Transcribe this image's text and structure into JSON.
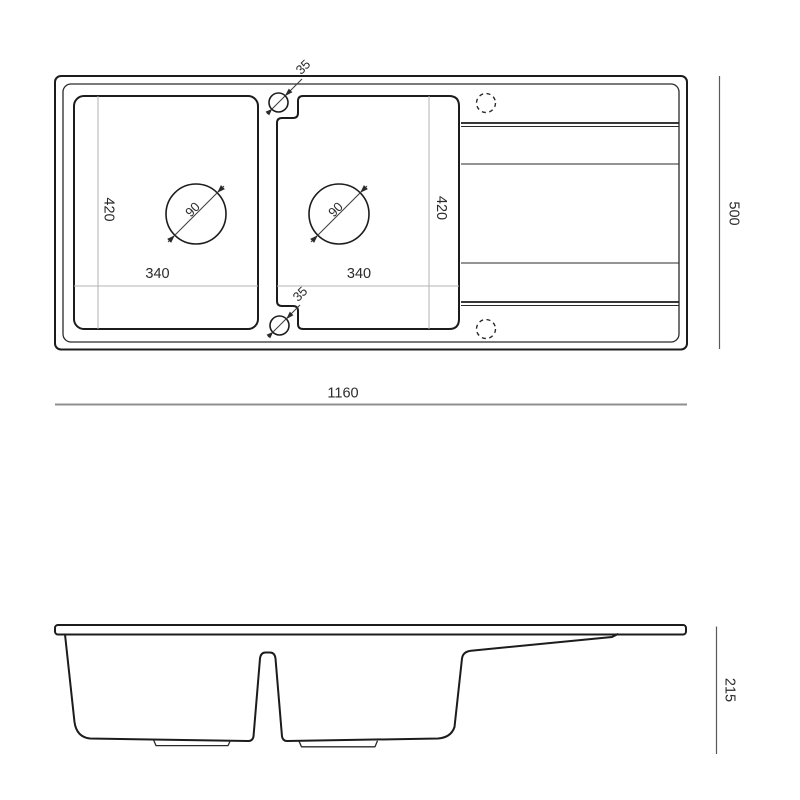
{
  "drawing": {
    "type": "kitchen-sink-technical-drawing",
    "views": [
      "top-view",
      "front-view"
    ]
  },
  "labels": {
    "tap_hole_top_diameter": "35",
    "tap_hole_bottom_diameter": "35",
    "bowl_left_depth": "420",
    "bowl_right_depth": "420",
    "bowl_left_width": "340",
    "bowl_right_width": "340",
    "drain_left_diameter": "90",
    "drain_right_diameter": "90",
    "overall_length": "1160",
    "overall_depth": "500",
    "overall_height": "215"
  },
  "colors": {
    "ink": "#1c1c1c",
    "extension_line": "#b3b3b3",
    "bottom_dim_line": "#8f8f8f",
    "side_dim_line": "#595959",
    "background": "#ffffff"
  }
}
